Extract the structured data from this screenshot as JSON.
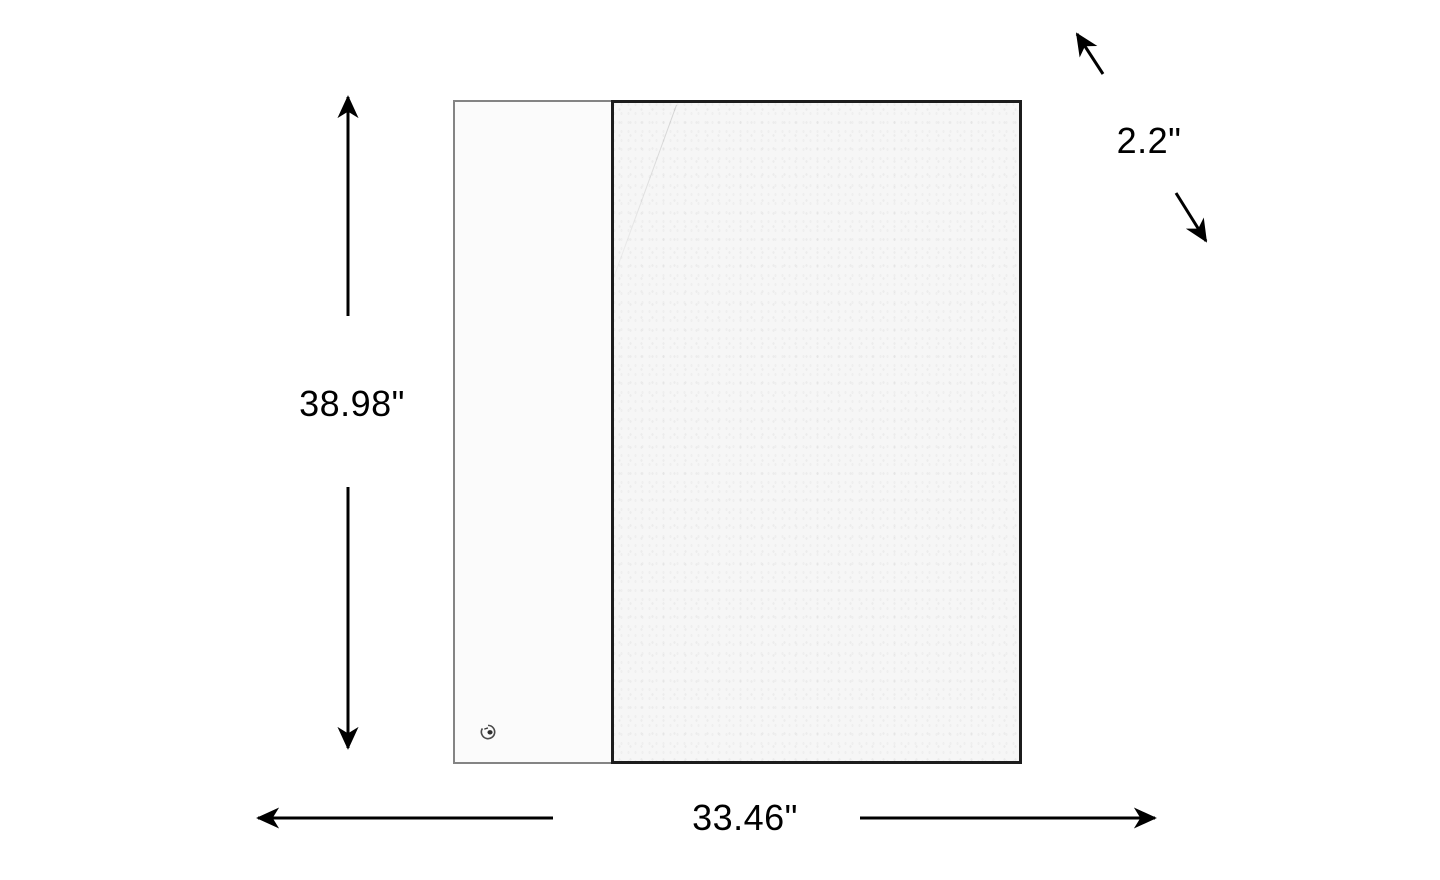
{
  "diagram": {
    "type": "product-dimensions",
    "dimensions": {
      "height_label": "38.98\"",
      "width_label": "33.46\"",
      "depth_label": "2.2\""
    },
    "colors": {
      "background": "#ffffff",
      "dimension_line": "#000000",
      "label_text": "#000000",
      "side_panel_border": "#848484",
      "door_border": "#1c1c1c",
      "side_panel_fill": "#fbfbfb",
      "door_fill": "#f6f6f6"
    },
    "icons": {
      "height_arrow_up": "↑",
      "height_arrow_down": "↓",
      "width_arrow_left": "←",
      "width_arrow_right": "→",
      "depth_arrow_up_left": "↖",
      "depth_arrow_down_right": "↘",
      "brand_logo": "◔"
    }
  }
}
